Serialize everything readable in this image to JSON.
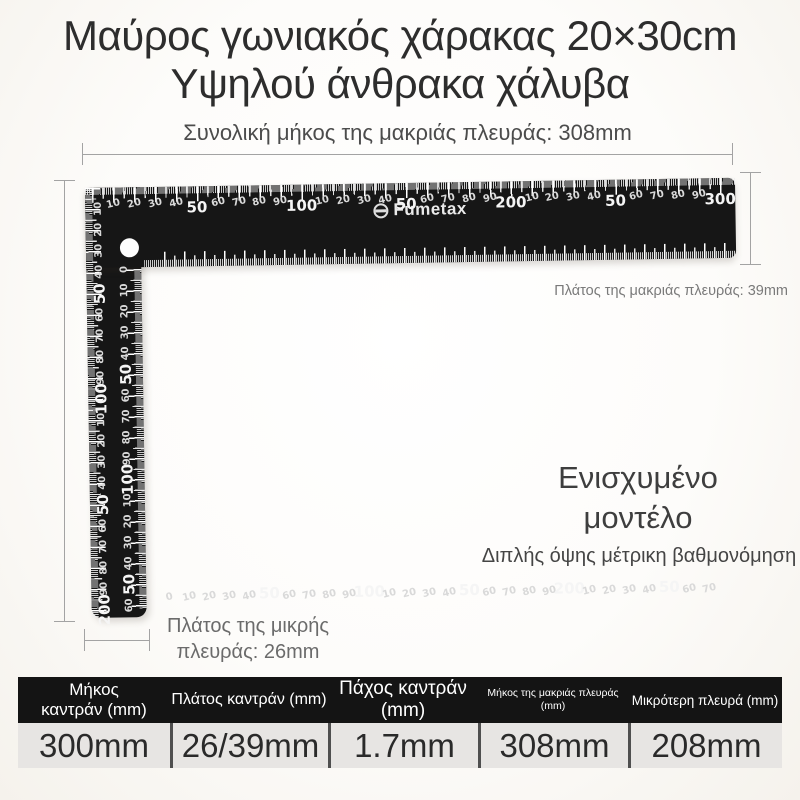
{
  "title": {
    "line1": "Μαύρος γωνιακός χάρακας 20×30cm",
    "line2": "Υψηλού άνθρακα χάλυβα"
  },
  "annotations": {
    "top_dim": "Συνολική μήκος της μακριάς πλευράς: 308mm",
    "right_dim": "Πλάτος της μακριάς πλευράς: 39mm",
    "bottom_dim_line1": "Πλάτος της μικρής",
    "bottom_dim_line2": "πλευράς: 26mm",
    "model_line1": "Ενισχυμένο",
    "model_line2": "μοντέλο",
    "feature": "Διπλής όψης μέτρικη βαθμονόμηση"
  },
  "ruler": {
    "brand": "Fumetax",
    "body_color": "#161616",
    "tick_color": "#f0f0f0",
    "scales": {
      "h_top": {
        "first_mm": 10,
        "step_mm": 10,
        "px_per_mm": 2.093,
        "origin_px": 7,
        "labels": [
          "10",
          "20",
          "30",
          "40",
          "50",
          "60",
          "70",
          "80",
          "90",
          "100",
          "10",
          "20",
          "30",
          "40",
          "50",
          "60",
          "70",
          "80",
          "90",
          "200",
          "10",
          "20",
          "30",
          "40",
          "50",
          "60",
          "70",
          "80",
          "90",
          "300"
        ]
      },
      "h_bottom": {
        "first_mm": 0,
        "step_mm": 10,
        "px_per_mm": 2.0,
        "origin_px": 78,
        "labels": [
          "0",
          "10",
          "20",
          "30",
          "40",
          "50",
          "60",
          "70",
          "80",
          "90",
          "100",
          "10",
          "20",
          "30",
          "40",
          "50",
          "60",
          "70",
          "80",
          "90",
          "200",
          "10",
          "20",
          "30",
          "40",
          "50",
          "60",
          "70"
        ]
      },
      "v_outer": {
        "first_mm": 10,
        "step_mm": 10,
        "px_per_mm": 2.11,
        "origin_px": 0,
        "labels": [
          "10",
          "20",
          "30",
          "40",
          "50",
          "60",
          "70",
          "80",
          "90",
          "100",
          "10",
          "20",
          "30",
          "40",
          "50",
          "60",
          "70",
          "80",
          "90",
          "200"
        ]
      },
      "v_inner": {
        "first_mm": 0,
        "step_mm": 10,
        "px_per_mm": 2.1,
        "origin_px": 82,
        "labels": [
          "0",
          "10",
          "20",
          "30",
          "40",
          "50",
          "60",
          "70",
          "80",
          "90",
          "100",
          "10",
          "20",
          "30",
          "40",
          "50",
          "60"
        ]
      }
    }
  },
  "table": {
    "columns": [
      {
        "header_top": "Μήκος",
        "header_bottom": "καντράν (mm)",
        "value": "300mm"
      },
      {
        "header_top": "Πλάτος καντράν (mm)",
        "header_bottom": "",
        "value": "26/39mm"
      },
      {
        "header_top": "Πάχος καντράν",
        "header_bottom": "(mm)",
        "value": "1.7mm"
      },
      {
        "header_top": "Μήκος της μακριάς πλευράς",
        "header_bottom": "(mm)",
        "value": "308mm"
      },
      {
        "header_top": "Μικρότερη πλευρά (mm)",
        "header_bottom": "",
        "value": "208mm"
      }
    ]
  }
}
